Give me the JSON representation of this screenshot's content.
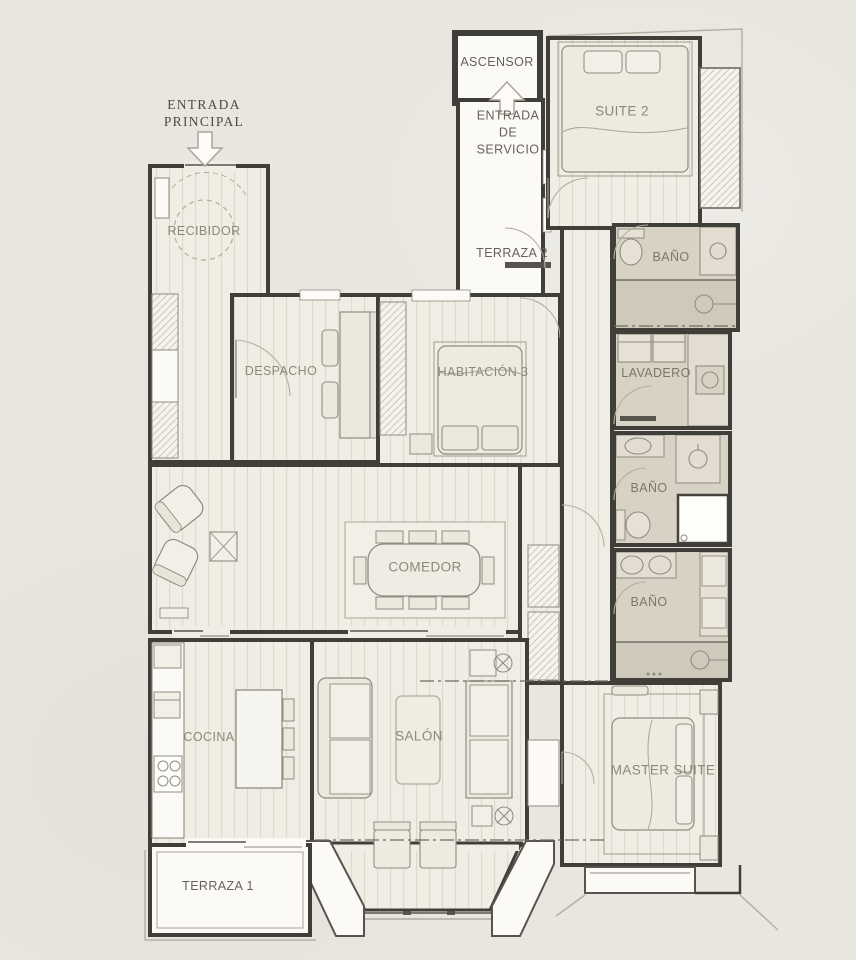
{
  "plan": {
    "annotations": {
      "entrada_principal": [
        "ENTRADA",
        "PRINCIPAL"
      ],
      "entrada_servicio": [
        "ENTRADA",
        "DE",
        "SERVICIO"
      ]
    },
    "rooms": {
      "ascensor": "ASCENSOR",
      "recibidor": "RECIBIDOR",
      "terraza_2": "TERRAZA 2",
      "suite_2": "SUITE 2",
      "bano_suite_2": "BAÑO",
      "despacho": "DESPACHO",
      "habitacion_3": "HABITACIÓN 3",
      "lavadero": "LAVADERO",
      "bano_2": "BAÑO",
      "comedor": "COMEDOR",
      "bano_3": "BAÑO",
      "cocina": "COCINA",
      "salon": "SALÓN",
      "master_suite": "MASTER SUITE",
      "terraza_1": "TERRAZA 1"
    },
    "colors": {
      "background": "#e9e6df",
      "wall": "#403e39",
      "wood_floor": "#f0ede4",
      "wood_stripe": "#dcd8cb",
      "bath_floor": "#d8d2c4",
      "shower_floor": "#cfc9bb",
      "terrace_floor": "#fbfaf6",
      "furniture_fill": "#ece8dd",
      "furniture_line": "#8f8c83",
      "label_grey": "#8c887a",
      "label_dark": "#65625a"
    }
  }
}
